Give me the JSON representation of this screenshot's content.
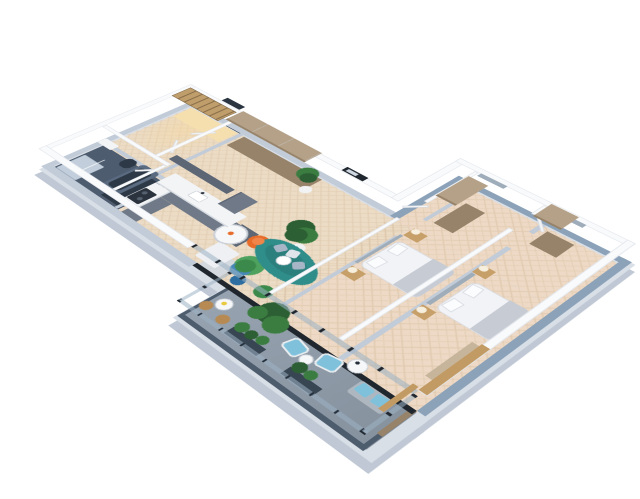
{
  "scene": {
    "type": "3d-isometric-apartment-floorplan-render",
    "background": "#ffffff",
    "text_visible": "",
    "rooms": [
      {
        "id": "entrance-hall",
        "items": [
          "entrance-door",
          "tall-tan-wardrobe-cabinet"
        ]
      },
      {
        "id": "walk-in-wardrobe",
        "items": [
          "lit-shelving-unit",
          "open-doors"
        ]
      },
      {
        "id": "bathroom",
        "items": [
          "bathtub",
          "shower-tray",
          "washbasin",
          "wc"
        ]
      },
      {
        "id": "kitchen",
        "items": [
          "l-shaped-gray-counter",
          "sink",
          "cooktop",
          "upper-cabinets",
          "fridge-unit",
          "white-island-block"
        ]
      },
      {
        "id": "living-dining-room",
        "items": [
          "wall-picture",
          "round-dining-table",
          "orange-chairs",
          "potted-plants",
          "green-armchair",
          "teal-oval-sofa",
          "blue-coffee-tables",
          "green-pouf",
          "glass-facade"
        ]
      },
      {
        "id": "bedroom-2",
        "items": [
          "double-bed",
          "nightstands-with-lamps",
          "tan-wardrobe",
          "gray-accent-panel",
          "door"
        ]
      },
      {
        "id": "bedroom-1",
        "items": [
          "double-bed",
          "nightstands-with-lamps",
          "tan-wardrobe",
          "tan-desk",
          "gray-accent-panel",
          "door"
        ]
      },
      {
        "id": "balcony",
        "items": [
          "glass-railing",
          "planter-boxes",
          "tall-plants",
          "blue-lounge-chairs",
          "white-side-table",
          "bistro-table",
          "wood-bistro-chairs",
          "bench-with-blue-cushions",
          "wood-privacy-panel"
        ]
      }
    ]
  },
  "palette": {
    "plinth": "#d9dfe7",
    "plinth_dark": "#bfc8d4",
    "floor_wood": "#ecdcc6",
    "floor_wood_line": "#d9c0a1",
    "floor_bed": "#edd9c5",
    "bath_floor": "#4e5c70",
    "tub_dark": "#2e3947",
    "tub_top": "#5a6a80",
    "shower": "#c2cedb",
    "wall_top": "#f9fafb",
    "wall_edge": "#e3e7ed",
    "wall_face": "#c2cbd8",
    "accent_wall": "#9fadbb",
    "ext_blue": "#8ba2b9",
    "door_dark": "#2b3441",
    "white_door": "#f3f4f6",
    "tan": "#b4a187",
    "tan_dark": "#96836a",
    "tan_light": "#c6b59b",
    "gray_cab": "#6f7987",
    "gray_cab_dark": "#5c6674",
    "counter": "#f3f4f6",
    "glow": "#f6dfae",
    "glow_soft": "rgba(246,217,160,0.55)",
    "shelf_wood": "#bf9e6c",
    "island": "#eef0f3",
    "island_face": "#d4d9e0",
    "sofa": "#2f8d8a",
    "sofa_dark": "#257170",
    "pillow_a": "#a7b6c6",
    "pillow_b": "#dfe4ea",
    "green1": "#4ea25e",
    "green2": "#3c8a4b",
    "orange": "#e76c2a",
    "orange_light": "#f0854a",
    "table_top": "#f6f7f8",
    "leg": "#c9cfd7",
    "blue_tbl": "#2d6da0",
    "blue_tbl2": "#4688b8",
    "plant": "#3b7d41",
    "plant_dark": "#2c5f33",
    "pot": "#f1f2f3",
    "planter": "#384552",
    "duvet": "#f2f3f6",
    "blanket": "#c6cbd4",
    "pillow_w": "#fbfcfd",
    "bed_edge": "#d7dbe2",
    "wood_ns": "#c79f68",
    "lamp": "#f7efdd",
    "balc_floor": "#97a3b0",
    "balc_floor2": "#87929f",
    "rail_dark": "#242e3a",
    "rail_glass": "rgba(156,178,196,0.55)",
    "rail_face": "#4e5d6e",
    "glass_frame": "#1f262e",
    "chair_blue": "#7fc1db",
    "wood_chair": "#b68a52",
    "bench": "#aeb7c0",
    "wood_panel": "#c29a63",
    "tv": "#20272f",
    "cook": "#2b333e",
    "burner": "#55606e",
    "flower": "#e8c93e"
  }
}
